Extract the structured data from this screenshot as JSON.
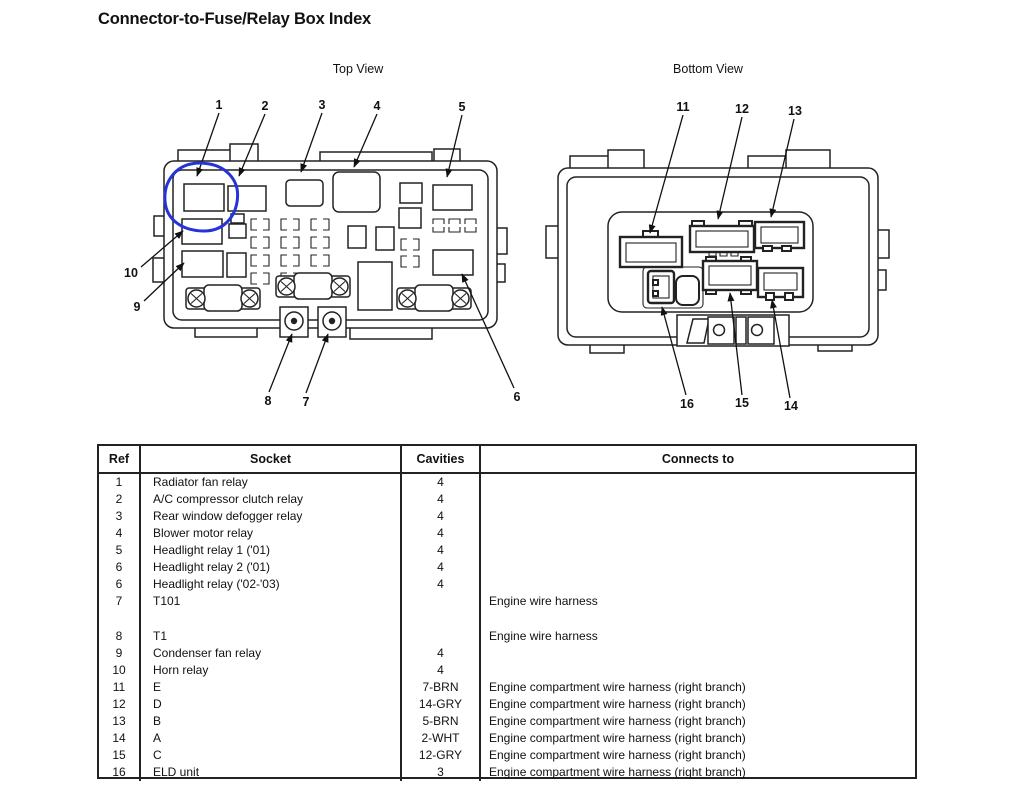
{
  "title": "Connector-to-Fuse/Relay Box Index",
  "diagram": {
    "top_view": {
      "label": "Top View",
      "callouts": [
        "1",
        "2",
        "3",
        "4",
        "5",
        "6",
        "7",
        "8",
        "9",
        "10"
      ],
      "annotation_color": "#2633d8",
      "annotation_note": "hand-drawn circle around socket 1"
    },
    "bottom_view": {
      "label": "Bottom View",
      "callouts": [
        "11",
        "12",
        "13",
        "14",
        "15",
        "16"
      ]
    }
  },
  "table": {
    "headers": [
      "Ref",
      "Socket",
      "Cavities",
      "Connects to"
    ],
    "rows": [
      {
        "ref": "1",
        "socket": "Radiator fan relay",
        "cavities": "4",
        "connects_to": ""
      },
      {
        "ref": "2",
        "socket": "A/C compressor clutch relay",
        "cavities": "4",
        "connects_to": ""
      },
      {
        "ref": "3",
        "socket": "Rear window defogger relay",
        "cavities": "4",
        "connects_to": ""
      },
      {
        "ref": "4",
        "socket": "Blower motor relay",
        "cavities": "4",
        "connects_to": ""
      },
      {
        "ref": "5",
        "socket": "Headlight relay 1 ('01)",
        "cavities": "4",
        "connects_to": ""
      },
      {
        "ref": "6",
        "socket": "Headlight relay 2 ('01)",
        "cavities": "4",
        "connects_to": ""
      },
      {
        "ref": "6",
        "socket": "Headlight relay ('02-'03)",
        "cavities": "4",
        "connects_to": ""
      },
      {
        "ref": "7",
        "socket": "T101",
        "cavities": "",
        "connects_to": "Engine wire harness",
        "tall": true
      },
      {
        "ref": "8",
        "socket": "T1",
        "cavities": "",
        "connects_to": "Engine wire harness"
      },
      {
        "ref": "9",
        "socket": "Condenser fan relay",
        "cavities": "4",
        "connects_to": ""
      },
      {
        "ref": "10",
        "socket": "Horn relay",
        "cavities": "4",
        "connects_to": ""
      },
      {
        "ref": "11",
        "socket": "E",
        "cavities": "7-BRN",
        "connects_to": "Engine compartment wire harness (right branch)"
      },
      {
        "ref": "12",
        "socket": "D",
        "cavities": "14-GRY",
        "connects_to": "Engine compartment wire harness (right branch)"
      },
      {
        "ref": "13",
        "socket": "B",
        "cavities": "5-BRN",
        "connects_to": "Engine compartment wire harness (right branch)"
      },
      {
        "ref": "14",
        "socket": "A",
        "cavities": "2-WHT",
        "connects_to": "Engine compartment wire harness (right branch)"
      },
      {
        "ref": "15",
        "socket": "C",
        "cavities": "12-GRY",
        "connects_to": "Engine compartment wire harness (right branch)"
      },
      {
        "ref": "16",
        "socket": "ELD unit",
        "cavities": "3",
        "connects_to": "Engine compartment wire harness (right branch)"
      }
    ]
  }
}
